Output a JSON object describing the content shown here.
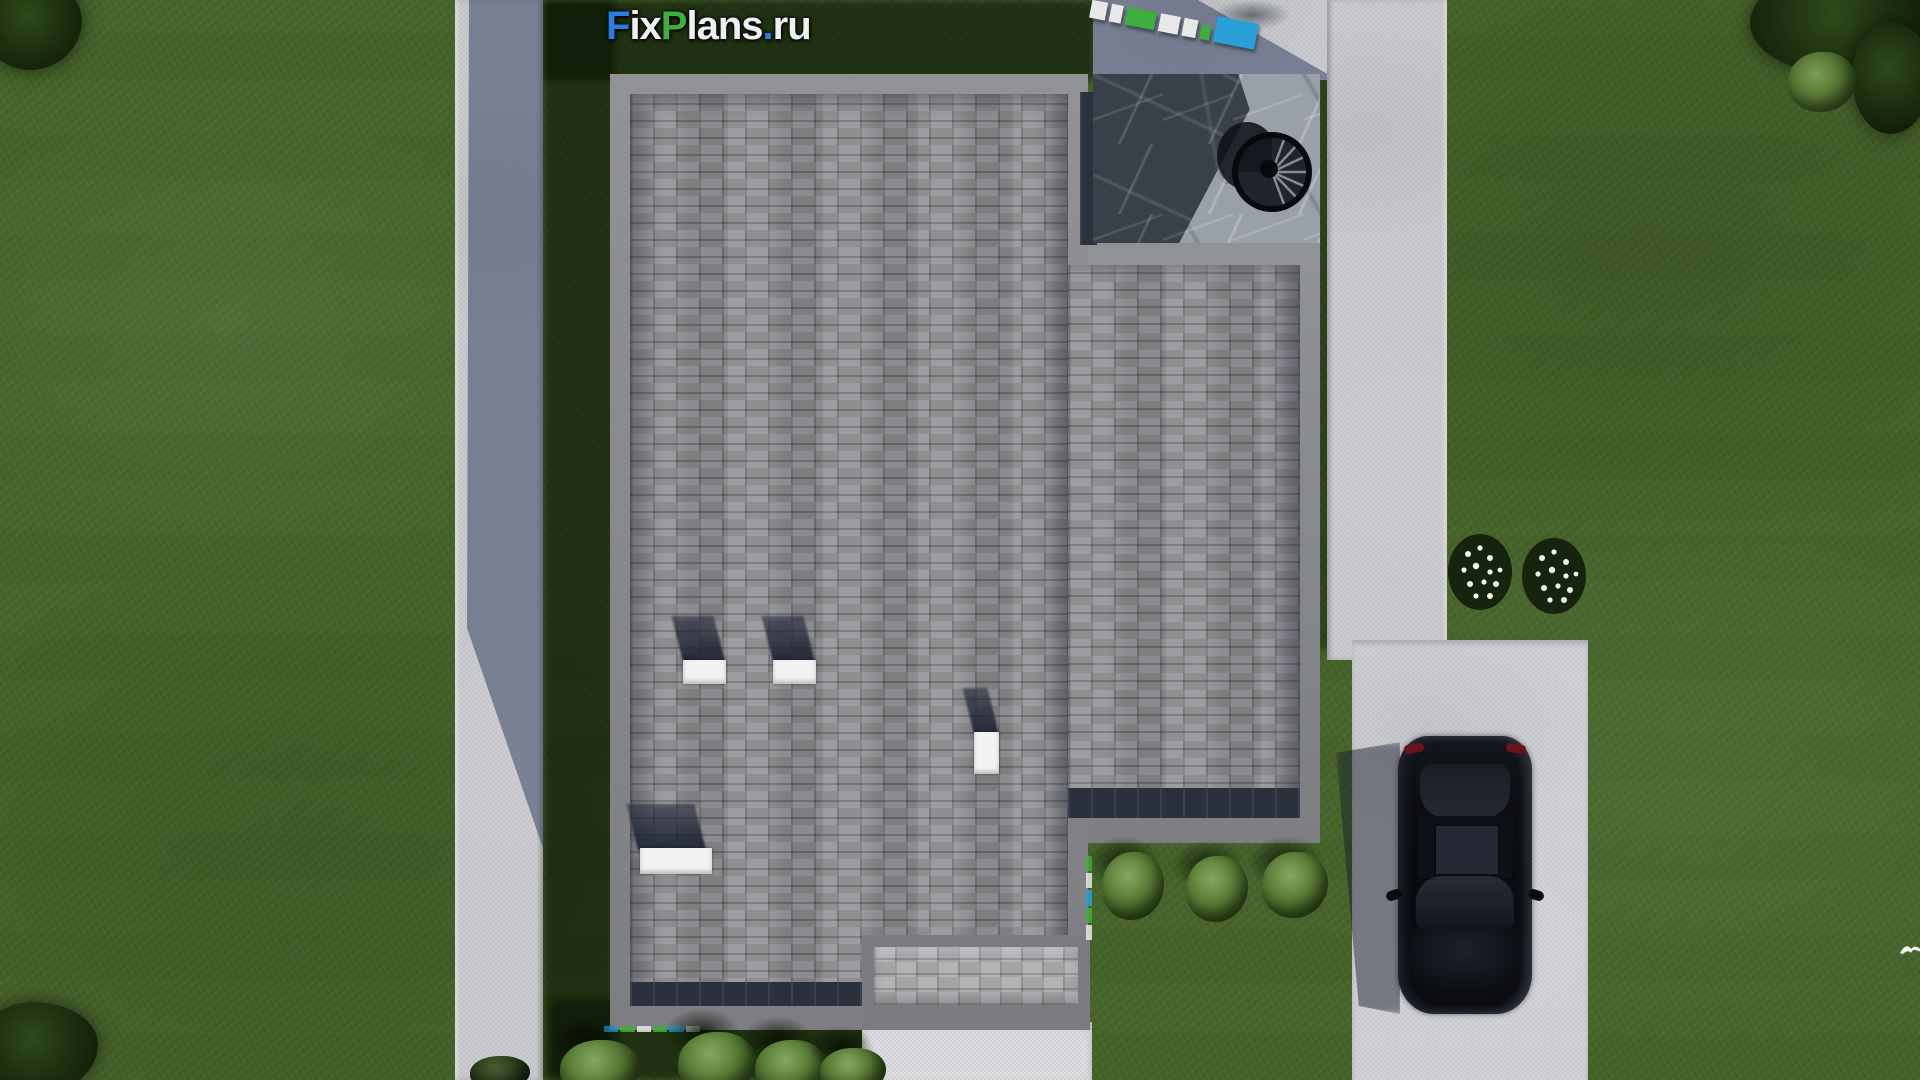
{
  "watermark_logo": {
    "text": "FixPlans.ru",
    "parts": [
      {
        "text": "F",
        "color": "#2b7de0"
      },
      {
        "text": "ix",
        "color": "#eef0f2"
      },
      {
        "text": "P",
        "color": "#3fae3f"
      },
      {
        "text": "lans",
        "color": "#eef0f2"
      },
      {
        "text": ".",
        "color": "#2b7de0"
      },
      {
        "text": "ru",
        "color": "#eef0f2"
      }
    ]
  },
  "scene": {
    "type": "aerial-3d-render",
    "subject": "Top-down 3D render of a house roof with yard, sidewalks, terrace with spiral stair, driveway and parked black car",
    "colors": {
      "grass_lit": "#4a672f",
      "grass_shadow": "#1e2d15",
      "roof_shingles": "#97979b",
      "roof_fascia": "#85868a",
      "roof_eave_shadow": "#2b303d",
      "terrace_marble_dark": "#394049",
      "terrace_marble_lit": "#9aa0a8",
      "concrete": "#cbccd0",
      "white_pad": "#dcdde0",
      "car": "#0d0f14",
      "chimney_caps": "#f2f2f2",
      "logo_blue": "#2b7de0",
      "logo_green": "#3fae3f"
    },
    "objects": [
      "house-roof",
      "terrace-with-spiral-stair",
      "chimney-caps",
      "roof-vent",
      "left-sidewalk",
      "right-sidewalk",
      "driveway",
      "parked-car",
      "lawn",
      "bushes",
      "flower-bushes",
      "trees",
      "white-bird",
      "ground-logo-stamp"
    ]
  }
}
